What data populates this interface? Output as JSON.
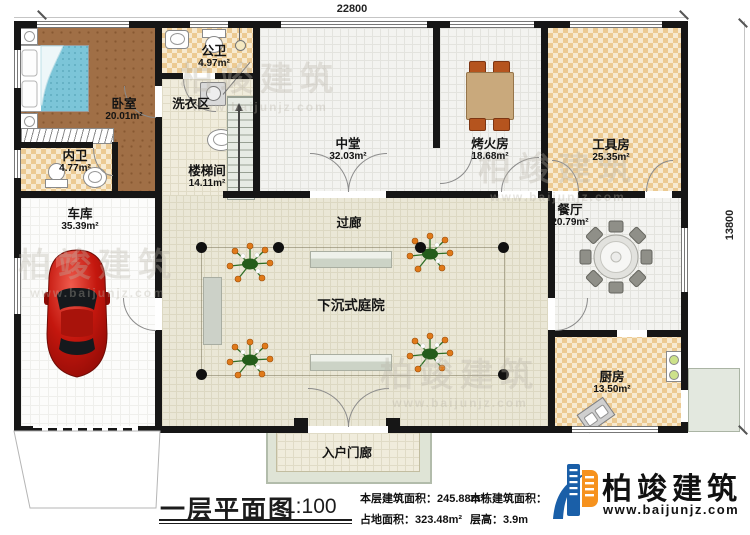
{
  "dimensions": {
    "top_width": "22800",
    "right_height": "13800"
  },
  "rooms": {
    "bedroom": {
      "name": "卧室",
      "area": "20.01m²"
    },
    "public_bath": {
      "name": "公卫",
      "area": "4.97m²"
    },
    "laundry": {
      "name": "洗衣区"
    },
    "inner_bath": {
      "name": "内卫",
      "area": "4.77m²"
    },
    "stairwell": {
      "name": "楼梯间",
      "area": "14.11m²"
    },
    "central_hall": {
      "name": "中堂",
      "area": "32.03m²"
    },
    "fire_room": {
      "name": "烤火房",
      "area": "18.68m²"
    },
    "tool_room": {
      "name": "工具房",
      "area": "25.35m²"
    },
    "dining_room": {
      "name": "餐厅",
      "area": "20.79m²"
    },
    "kitchen": {
      "name": "厨房",
      "area": "13.50m²"
    },
    "garage": {
      "name": "车库",
      "area": "35.39m²"
    },
    "corridor": {
      "name": "过廊"
    },
    "courtyard": {
      "name": "下沉式庭院"
    },
    "entry_porch": {
      "name": "入户门廊"
    }
  },
  "title_block": {
    "title": "一层平面图",
    "scale": "1:100",
    "floor_area_label": "本层建筑面积：",
    "floor_area_value": "245.88m²",
    "site_area_label": "占地面积：",
    "site_area_value": "323.48m²",
    "building_area_label": "本栋建筑面积：",
    "building_area_value": "",
    "story_height_label": "层高：",
    "story_height_value": "3.9m"
  },
  "logo": {
    "company": "柏竣建筑",
    "website": "www.baijunjz.com"
  },
  "watermark": {
    "text": "柏竣建筑",
    "subtext": "www.baijunjz.com"
  },
  "colors": {
    "wall": "#161616",
    "logo_blue": "#1a5fa8",
    "logo_orange": "#f6921e",
    "checker_tan": "#ecca92",
    "courtyard_beige": "#eae7d6",
    "wood_brown": "#a06f46"
  }
}
